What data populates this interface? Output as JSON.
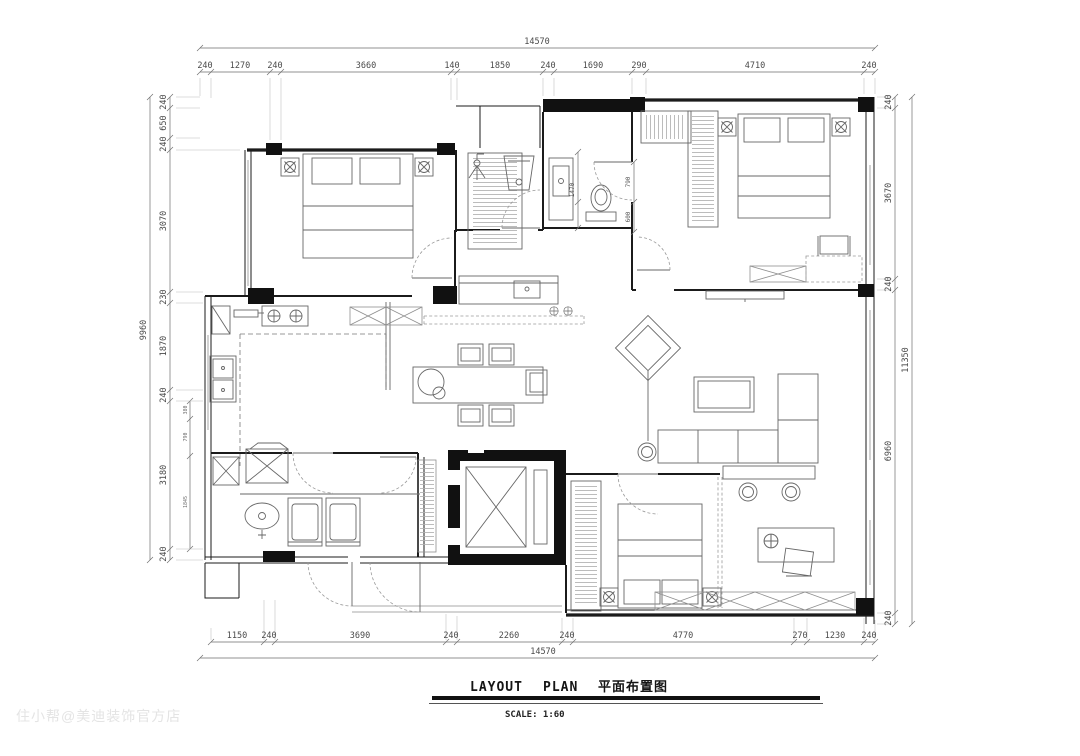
{
  "document": {
    "title_en_1": "LAYOUT",
    "title_en_2": "PLAN",
    "title_zh": "平面布置图",
    "scale_label": "SCALE: 1:60",
    "watermark": "住小帮@美迪装饰官方店"
  },
  "drawing": {
    "type": "residential floor plan",
    "rooms": [
      "bedroom-top-left",
      "shower-room",
      "bathroom",
      "master-bedroom",
      "kitchen",
      "dining-area",
      "hallway",
      "living-room",
      "laundry-room",
      "corridor-bath",
      "elevator-shaft",
      "entry-porch",
      "bedroom-bottom",
      "study-area"
    ]
  },
  "dimensions": {
    "top": {
      "overall": "14570",
      "segments": [
        "240",
        "1270",
        "240",
        "3660",
        "140",
        "1850",
        "240",
        "1690",
        "290",
        "4710",
        "240"
      ]
    },
    "bottom": {
      "overall": "14570",
      "segments": [
        "1150",
        "240",
        "3690",
        "240",
        "2260",
        "240",
        "4770",
        "270",
        "1230",
        "240"
      ]
    },
    "left": {
      "overall": "9960",
      "segments": [
        "240",
        "650",
        "240",
        "3070",
        "230",
        "1870",
        "240",
        "3180",
        "240"
      ]
    },
    "right": {
      "overall": "11350",
      "segments": [
        "240",
        "3670",
        "240",
        "6960",
        "240"
      ]
    },
    "bathroom_interior": [
      "1470",
      "790",
      "600"
    ],
    "laundry_interior": [
      "380",
      "790",
      "1845"
    ]
  },
  "colors": {
    "wall": "#1b1b1b",
    "furniture_line": "#676767",
    "dimension_text": "#4a4a4a",
    "watermark": "#e4e4e4",
    "background": "#ffffff"
  }
}
